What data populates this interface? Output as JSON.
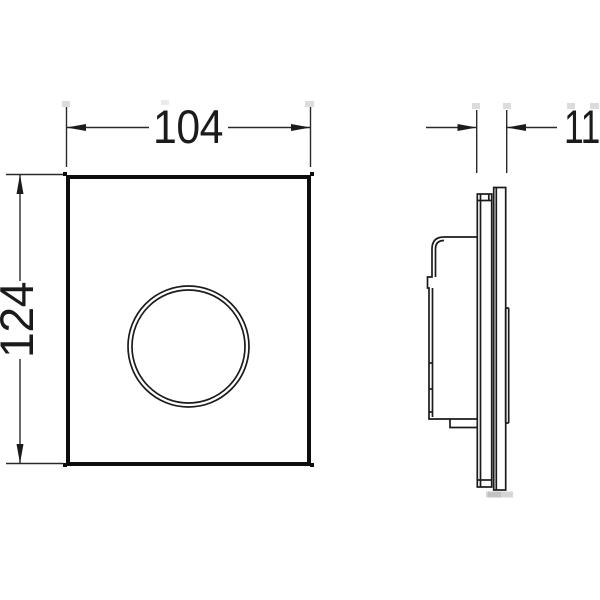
{
  "drawing": {
    "type": "technical-dimension-drawing",
    "views": {
      "front": "flush-plate front view with round push button",
      "side": "flush-plate side profile with mounting housing"
    },
    "dimensions": {
      "width_label": "104",
      "height_label": "124",
      "depth_label": "11"
    },
    "colors": {
      "line": "#1b1b1b",
      "background": "#ffffff",
      "shadow": "#c9c9c9"
    }
  }
}
